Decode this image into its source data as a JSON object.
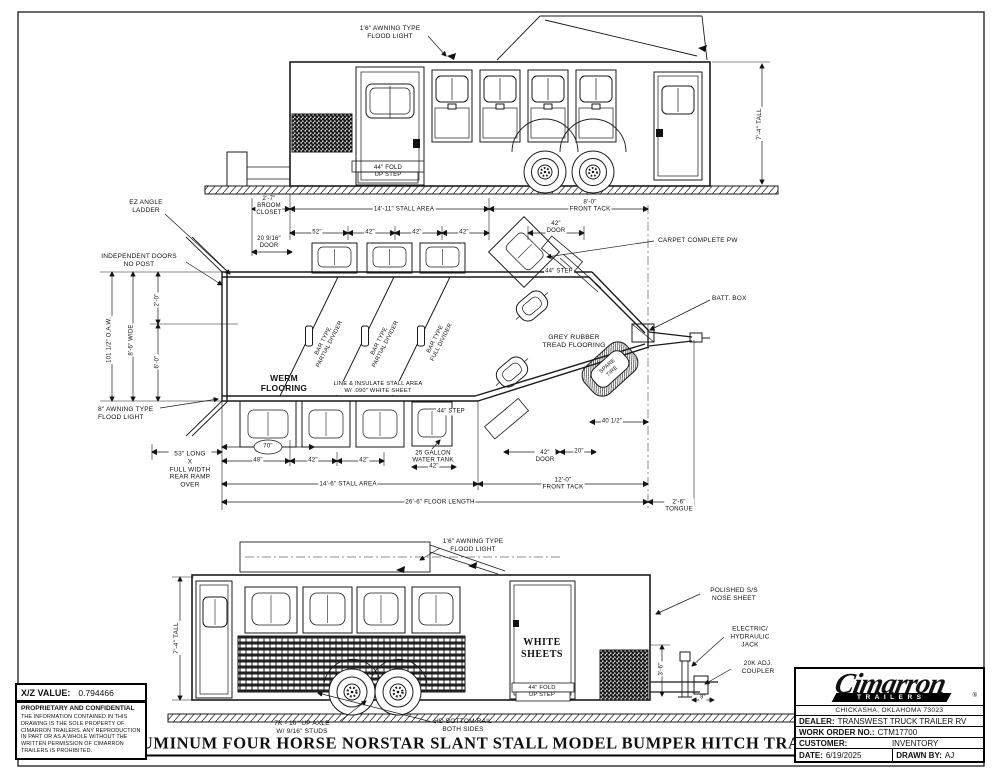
{
  "sheet": {
    "xz_value_label": "X/Z VALUE:",
    "xz_value": "0.794466",
    "proprietary_title": "PROPRIETARY AND CONFIDENTIAL",
    "proprietary_text": "THE INFORMATION CONTAINED IN THIS DRAWING IS THE SOLE PROPERTY OF CIMARRON TRAILERS. ANY REPRODUCTION IN PART OR AS A WHOLE WITHOUT THE WRITTEN PERMISSION OF CIMARRON TRAILERS IS PROHIBITED.",
    "drawing_title": "ALUMINUM FOUR HORSE NORSTAR SLANT STALL MODEL BUMPER HITCH TRAILER"
  },
  "title_block": {
    "logo_text": "Cimarron",
    "logo_sub": "TRAILERS",
    "registered_mark": "®",
    "address": "CHICKASHA, OKLAHOMA 73023",
    "dealer_label": "DEALER:",
    "dealer": "TRANSWEST TRUCK TRAILER RV",
    "work_order_label": "WORK ORDER NO.:",
    "work_order": "CTM17700",
    "customer_label": "CUSTOMER:",
    "customer": "INVENTORY",
    "date_label": "DATE:",
    "date": "6/19/2025",
    "drawn_by_label": "DRAWN BY:",
    "drawn_by": "AJ"
  },
  "labels": [
    {
      "name": "note-awning-flood-light-top",
      "text": "1'6\" AWNING TYPE\nFLOOD LIGHT",
      "x": 390,
      "y": 33
    },
    {
      "name": "dim-height-top-view",
      "text": "7'-4\" TALL",
      "x": 760,
      "y": 124,
      "rot": -90,
      "bg": 1,
      "size": 6.5
    },
    {
      "name": "note-fold-up-step-top",
      "text": "44\" FOLD\nUP STEP",
      "x": 388,
      "y": 172,
      "size": 6
    },
    {
      "name": "dim-broom-closet",
      "text": "2'-7\"\nBROOM\nCLOSET",
      "x": 269,
      "y": 207,
      "bg": 1,
      "size": 6
    },
    {
      "name": "dim-stall-area-top",
      "text": "14'-11\" STALL AREA",
      "x": 404,
      "y": 209,
      "bg": 1,
      "size": 6.2
    },
    {
      "name": "dim-front-tack-top",
      "text": "8'-0\"\nFRONT TACK",
      "x": 590,
      "y": 206,
      "bg": 1,
      "size": 6.2
    },
    {
      "name": "dim-door-20-9-16",
      "text": "20 9/16\"\nDOOR",
      "x": 269,
      "y": 243,
      "bg": 1,
      "size": 6
    },
    {
      "name": "dim-52",
      "text": "52\"",
      "x": 317,
      "y": 233,
      "bg": 1,
      "size": 6
    },
    {
      "name": "dim-42-a",
      "text": "42\"",
      "x": 370,
      "y": 233,
      "bg": 1,
      "size": 6
    },
    {
      "name": "dim-42-b",
      "text": "42\"",
      "x": 417,
      "y": 233,
      "bg": 1,
      "size": 6
    },
    {
      "name": "dim-42-c",
      "text": "42\"",
      "x": 464,
      "y": 233,
      "bg": 1,
      "size": 6
    },
    {
      "name": "dim-42-door-top",
      "text": "42\"\nDOOR",
      "x": 556,
      "y": 228,
      "bg": 1,
      "size": 6
    },
    {
      "name": "note-carpet",
      "text": "CARPET COMPLETE PW",
      "x": 658,
      "y": 241,
      "align": "left"
    },
    {
      "name": "note-batt-box",
      "text": "BATT. BOX",
      "x": 712,
      "y": 299,
      "align": "left"
    },
    {
      "name": "note-ez-ladder",
      "text": "EZ ANGLE\nLADDER",
      "x": 146,
      "y": 207
    },
    {
      "name": "note-independent-doors",
      "text": "INDEPENDENT DOORS\nNO POST",
      "x": 139,
      "y": 261
    },
    {
      "name": "dim-oaw",
      "text": "101 1/2\" O.A.W.",
      "x": 110,
      "y": 340,
      "rot": -90,
      "bg": 1,
      "size": 6
    },
    {
      "name": "dim-wide",
      "text": "8'-6\" WIDE",
      "x": 132,
      "y": 340,
      "rot": -90,
      "bg": 1,
      "size": 6
    },
    {
      "name": "dim-2-0",
      "text": "2'-0\"",
      "x": 158,
      "y": 300,
      "rot": -90,
      "bg": 1,
      "size": 6
    },
    {
      "name": "dim-6-0",
      "text": "6'-0\"",
      "x": 158,
      "y": 362,
      "rot": -90,
      "bg": 1,
      "size": 6
    },
    {
      "name": "note-awning-flood-light-rear",
      "text": "8\" AWNING TYPE\nFLOOD LIGHT",
      "x": 98,
      "y": 414,
      "align": "left"
    },
    {
      "name": "note-werm-flooring",
      "text": "WERM\nFLOORING",
      "x": 284,
      "y": 383,
      "bold": 1,
      "size": 8.5
    },
    {
      "name": "note-partial-divider-1",
      "text": "BAR TYPE\nPARTIAL DIVIDER",
      "x": 327,
      "y": 343,
      "rot": -63,
      "size": 5.8
    },
    {
      "name": "note-partial-divider-2",
      "text": "BAR TYPE\nPARTIAL DIVIDER",
      "x": 383,
      "y": 343,
      "rot": -63,
      "size": 5.8
    },
    {
      "name": "note-full-divider",
      "text": "BAR TYPE\nFULL DIVIDER",
      "x": 439,
      "y": 341,
      "rot": -63,
      "size": 5.8
    },
    {
      "name": "note-line-insulate",
      "text": "LINE & INSULATE STALL AREA\nW/ .090\" WHITE SHEET",
      "x": 378,
      "y": 388,
      "size": 5.8,
      "bg": 1
    },
    {
      "name": "note-grey-rubber",
      "text": "GREY RUBBER\nTREAD FLOORING",
      "x": 574,
      "y": 342,
      "size": 6.8
    },
    {
      "name": "dim-44-step-top",
      "text": "44\" STEP",
      "x": 559,
      "y": 272,
      "bg": 1,
      "size": 6
    },
    {
      "name": "dim-44-step-bottom",
      "text": "44\" STEP",
      "x": 451,
      "y": 412,
      "bg": 1,
      "size": 6
    },
    {
      "name": "note-water-tank",
      "text": "25 GALLON\nWATER TANK",
      "x": 433,
      "y": 457,
      "bg": 1,
      "size": 6.2
    },
    {
      "name": "dim-70",
      "text": "70\"",
      "x": 268,
      "y": 447,
      "size": 6
    },
    {
      "name": "dim-48",
      "text": "48\"",
      "x": 258,
      "y": 461,
      "bg": 1,
      "size": 6
    },
    {
      "name": "dim-42-d",
      "text": "42\"",
      "x": 313,
      "y": 461,
      "bg": 1,
      "size": 6
    },
    {
      "name": "dim-42-e",
      "text": "42\"",
      "x": 364,
      "y": 461,
      "bg": 1,
      "size": 6
    },
    {
      "name": "dim-42-f",
      "text": "42\"",
      "x": 434,
      "y": 467,
      "bg": 1,
      "size": 6
    },
    {
      "name": "dim-stall-area-bottom",
      "text": "14'-6\" STALL AREA",
      "x": 348,
      "y": 484,
      "bg": 1,
      "size": 6.2
    },
    {
      "name": "note-rear-ramp",
      "text": "53\" LONG\nX\nFULL WIDTH\nREAR RAMP\nOVER",
      "x": 190,
      "y": 470,
      "bg": 1
    },
    {
      "name": "dim-front-tack-bottom",
      "text": "12'-0\"\nFRONT TACK",
      "x": 563,
      "y": 484,
      "bg": 1,
      "size": 6.2
    },
    {
      "name": "dim-floor-length",
      "text": "26'-6\" FLOOR LENGTH",
      "x": 440,
      "y": 502,
      "bg": 1,
      "size": 6.2
    },
    {
      "name": "dim-tongue",
      "text": "2'-6\"\nTONGUE",
      "x": 679,
      "y": 506,
      "bg": 1,
      "size": 6.2
    },
    {
      "name": "dim-40-half",
      "text": "40 1/2\"",
      "x": 612,
      "y": 422,
      "bg": 1,
      "size": 6
    },
    {
      "name": "dim-20",
      "text": "20\"",
      "x": 579,
      "y": 452,
      "bg": 1,
      "size": 6
    },
    {
      "name": "dim-42-door-bottom",
      "text": "42\"\nDOOR",
      "x": 545,
      "y": 457,
      "bg": 1,
      "size": 6
    },
    {
      "name": "note-spare-tire",
      "text": "SPARE\nTIRE",
      "x": 610,
      "y": 369,
      "rot": -42,
      "size": 5.5
    },
    {
      "name": "note-awning-flood-light-bottomview",
      "text": "1'6\" AWNING TYPE\nFLOOD LIGHT",
      "x": 473,
      "y": 546
    },
    {
      "name": "dim-height-bottom-view",
      "text": "7'-4\" TALL",
      "x": 177,
      "y": 638,
      "rot": -90,
      "bg": 1,
      "size": 6.5
    },
    {
      "name": "note-white-sheets",
      "text": "WHITE\nSHEETS",
      "x": 542,
      "y": 649,
      "bold": 1,
      "serif": 1,
      "size": 10
    },
    {
      "name": "note-fold-up-step-bottom",
      "text": "44\" FOLD\nUP STEP",
      "x": 542,
      "y": 692,
      "size": 5.8
    },
    {
      "name": "note-nose-sheet",
      "text": "POLISHED S/S\nNOSE SHEET",
      "x": 734,
      "y": 595
    },
    {
      "name": "note-jack",
      "text": "ELECTRIC/\nHYDRAULIC\nJACK",
      "x": 750,
      "y": 637
    },
    {
      "name": "note-coupler",
      "text": "20K ADJ.\nCOUPLER",
      "x": 758,
      "y": 668
    },
    {
      "name": "dim-3-6",
      "text": "3'-6\"",
      "x": 662,
      "y": 669,
      "rot": -90,
      "bg": 1,
      "size": 6
    },
    {
      "name": "dim-8",
      "text": "8\"",
      "x": 703,
      "y": 698,
      "bg": 1,
      "size": 5.5
    },
    {
      "name": "note-axle",
      "text": "7K - 10° UP AXLE\nW/ 9/16\" STUDS",
      "x": 302,
      "y": 728
    },
    {
      "name": "note-bottom-rail",
      "text": "HD BOTTOM RAIL\nBOTH SIDES",
      "x": 463,
      "y": 726
    }
  ]
}
